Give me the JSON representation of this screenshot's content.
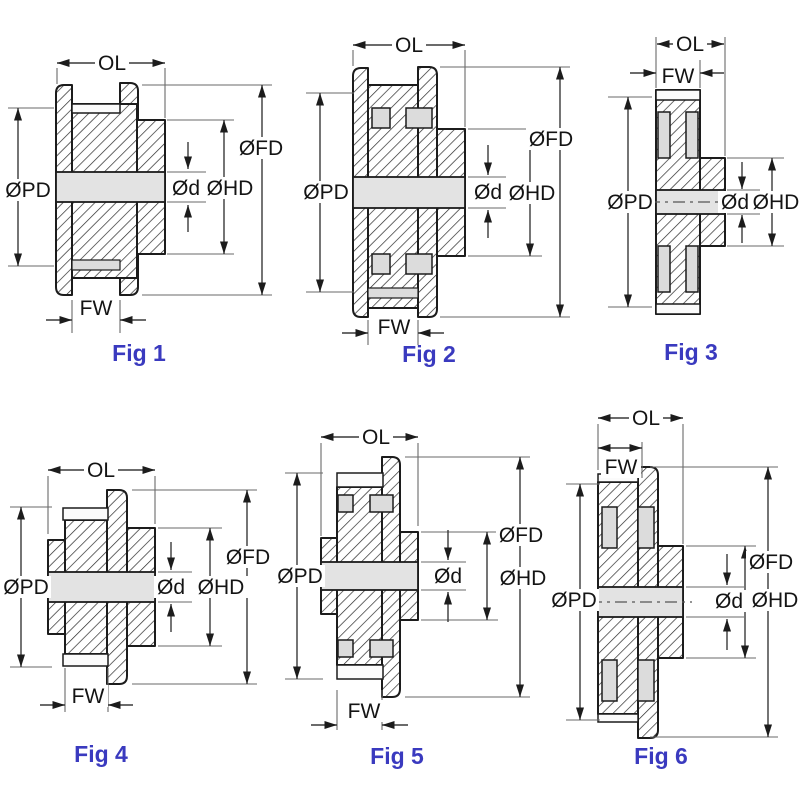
{
  "figures": [
    {
      "caption": "Fig 1",
      "labels": {
        "ol": "OL",
        "fw": "FW",
        "pd": "ØPD",
        "fd": "ØFD",
        "hd": "ØHD",
        "d": "Ød"
      }
    },
    {
      "caption": "Fig 2",
      "labels": {
        "ol": "OL",
        "fw": "FW",
        "pd": "ØPD",
        "fd": "ØFD",
        "hd": "ØHD",
        "d": "Ød"
      }
    },
    {
      "caption": "Fig 3",
      "labels": {
        "ol": "OL",
        "fw": "FW",
        "pd": "ØPD",
        "hd": "ØHD",
        "d": "Ød"
      }
    },
    {
      "caption": "Fig 4",
      "labels": {
        "ol": "OL",
        "fw": "FW",
        "pd": "ØPD",
        "fd": "ØFD",
        "hd": "ØHD",
        "d": "Ød"
      }
    },
    {
      "caption": "Fig 5",
      "labels": {
        "ol": "OL",
        "fw": "FW",
        "pd": "ØPD",
        "fd": "ØFD",
        "hd": "ØHD",
        "d": "Ød"
      }
    },
    {
      "caption": "Fig 6",
      "labels": {
        "ol": "OL",
        "fw": "FW",
        "pd": "ØPD",
        "fd": "ØFD",
        "hd": "ØHD",
        "d": "Ød"
      }
    }
  ],
  "colors": {
    "caption_blue": "#3A3ABF",
    "line": "#1c1c1c",
    "bore_gray": "#e3e3e3",
    "recess_gray": "#dcdcdc"
  }
}
